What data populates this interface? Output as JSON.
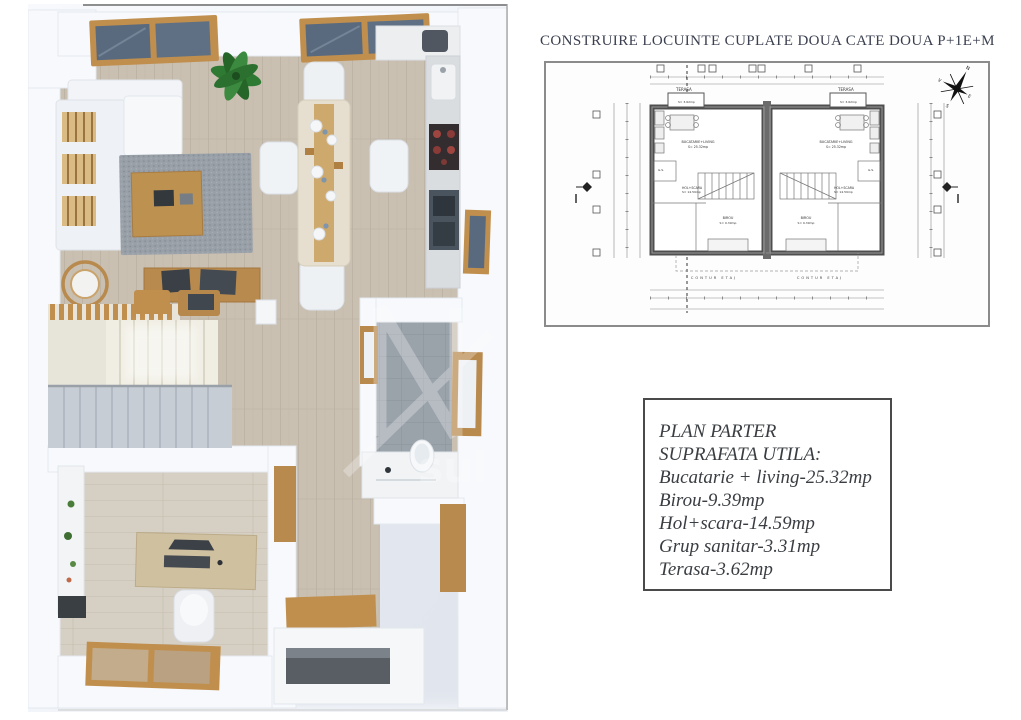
{
  "title": "CONSTRUIRE LOCUINTE CUPLATE DOUA CATE DOUA P+1E+M",
  "area_box": {
    "heading1": "PLAN PARTER",
    "heading2": "SUPRAFATA UTILA:",
    "items": [
      "Bucatarie + living-25.32mp",
      "Birou-9.39mp",
      "Hol+scara-14.59mp",
      "Grup sanitar-3.31mp",
      "Terasa-3.62mp"
    ]
  },
  "blueprint": {
    "labels": {
      "terasa": "TERASA",
      "terasa_area": "S= 3.62mp",
      "living": "BUCATARIE+LIVING",
      "living_area": "S= 25.32mp",
      "hol": "HOL+SCARA",
      "hol_area": "S= 14.59mp",
      "birou": "BIROU",
      "birou_area": "S= 9.39mp",
      "gs": "G.S.",
      "contur": "CONTUR ETAJ"
    },
    "compass": {
      "n": "N",
      "e": "E",
      "s": "S",
      "v": "V"
    }
  },
  "watermark": "sul",
  "colors": {
    "wood": "#c08f4e",
    "glass": "#5a6a7e",
    "floor": "#c9c0b2",
    "tile": "#9aa2aa",
    "wall": "#f7f9fc",
    "title_text": "#3b4050"
  }
}
